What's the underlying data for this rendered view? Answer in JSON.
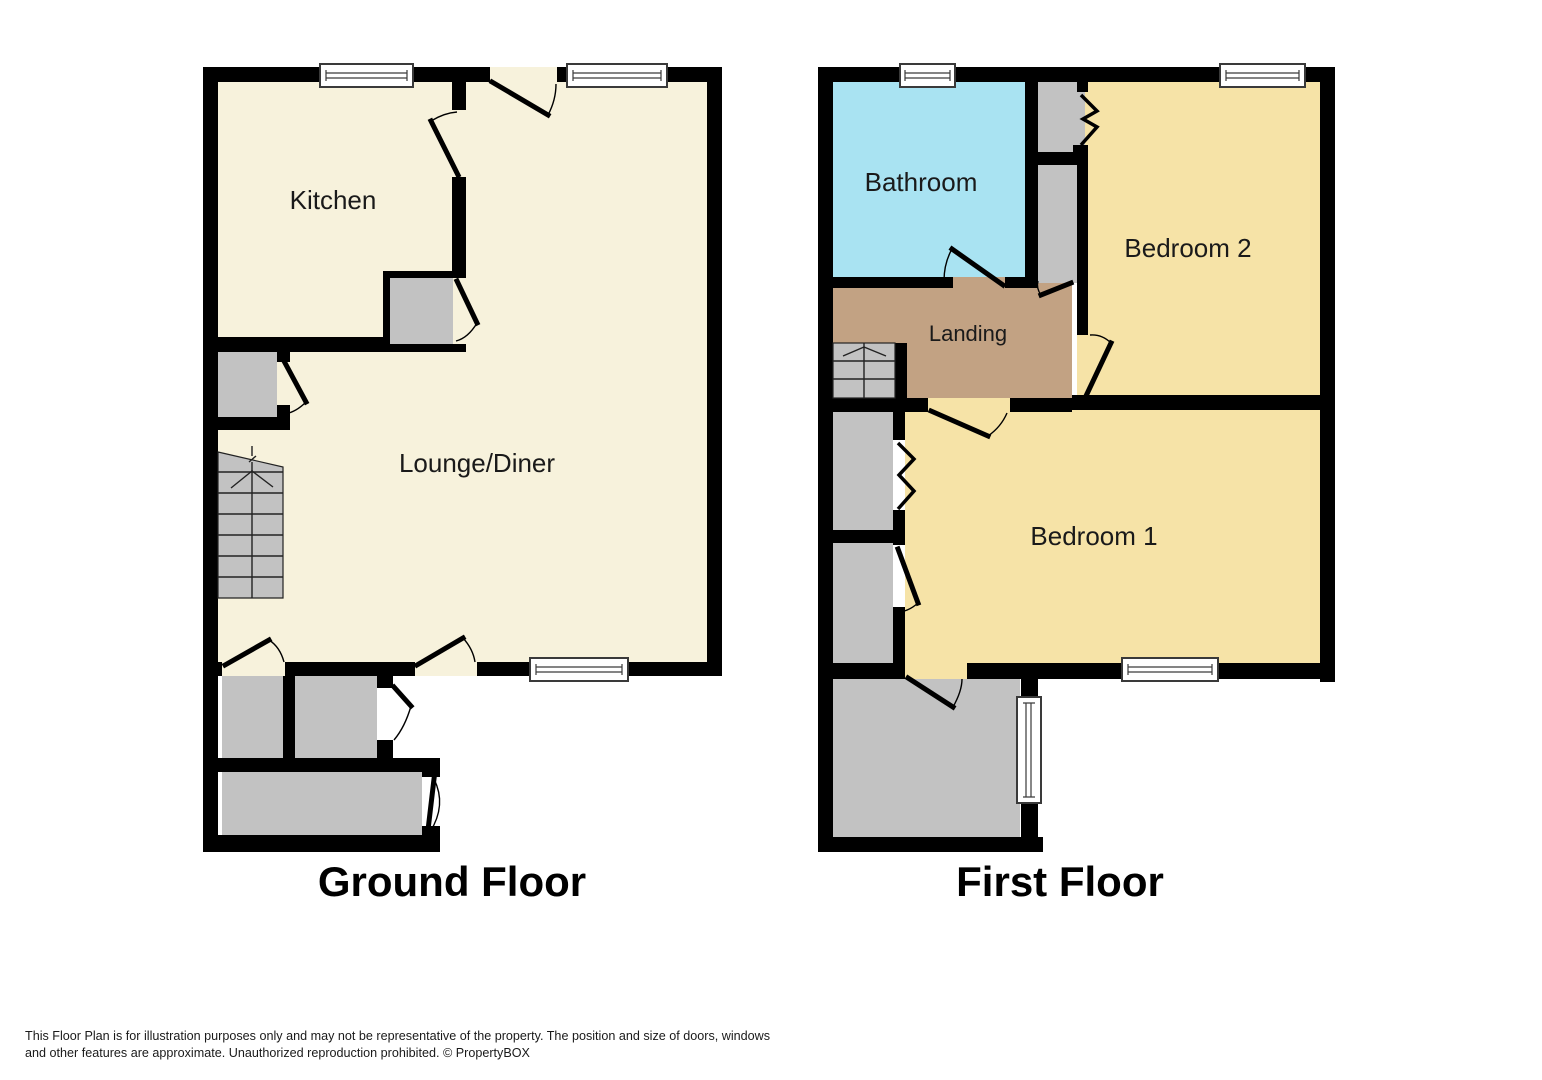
{
  "page": {
    "background": "#FFFFFF"
  },
  "colors": {
    "wall": "#000000",
    "floor-cream": "#F7F2DC",
    "floor-yellow": "#F6E3A7",
    "floor-cyan": "#A9E3F2",
    "floor-tan": "#C2A283",
    "floor-gray": "#C2C2C2",
    "window-fill": "#FFFFFF"
  },
  "ground_floor": {
    "caption": "Ground Floor",
    "rooms": {
      "kitchen": "Kitchen",
      "lounge": "Lounge/Diner"
    }
  },
  "first_floor": {
    "caption": "First Floor",
    "rooms": {
      "bathroom": "Bathroom",
      "bedroom2": "Bedroom 2",
      "landing": "Landing",
      "bedroom1": "Bedroom 1"
    }
  },
  "footer": {
    "line1": "This Floor Plan is for illustration purposes only and may not be representative of the property. The position and size of doors, windows",
    "line2": "and other features are approximate. Unauthorized reproduction prohibited. © PropertyBOX"
  }
}
